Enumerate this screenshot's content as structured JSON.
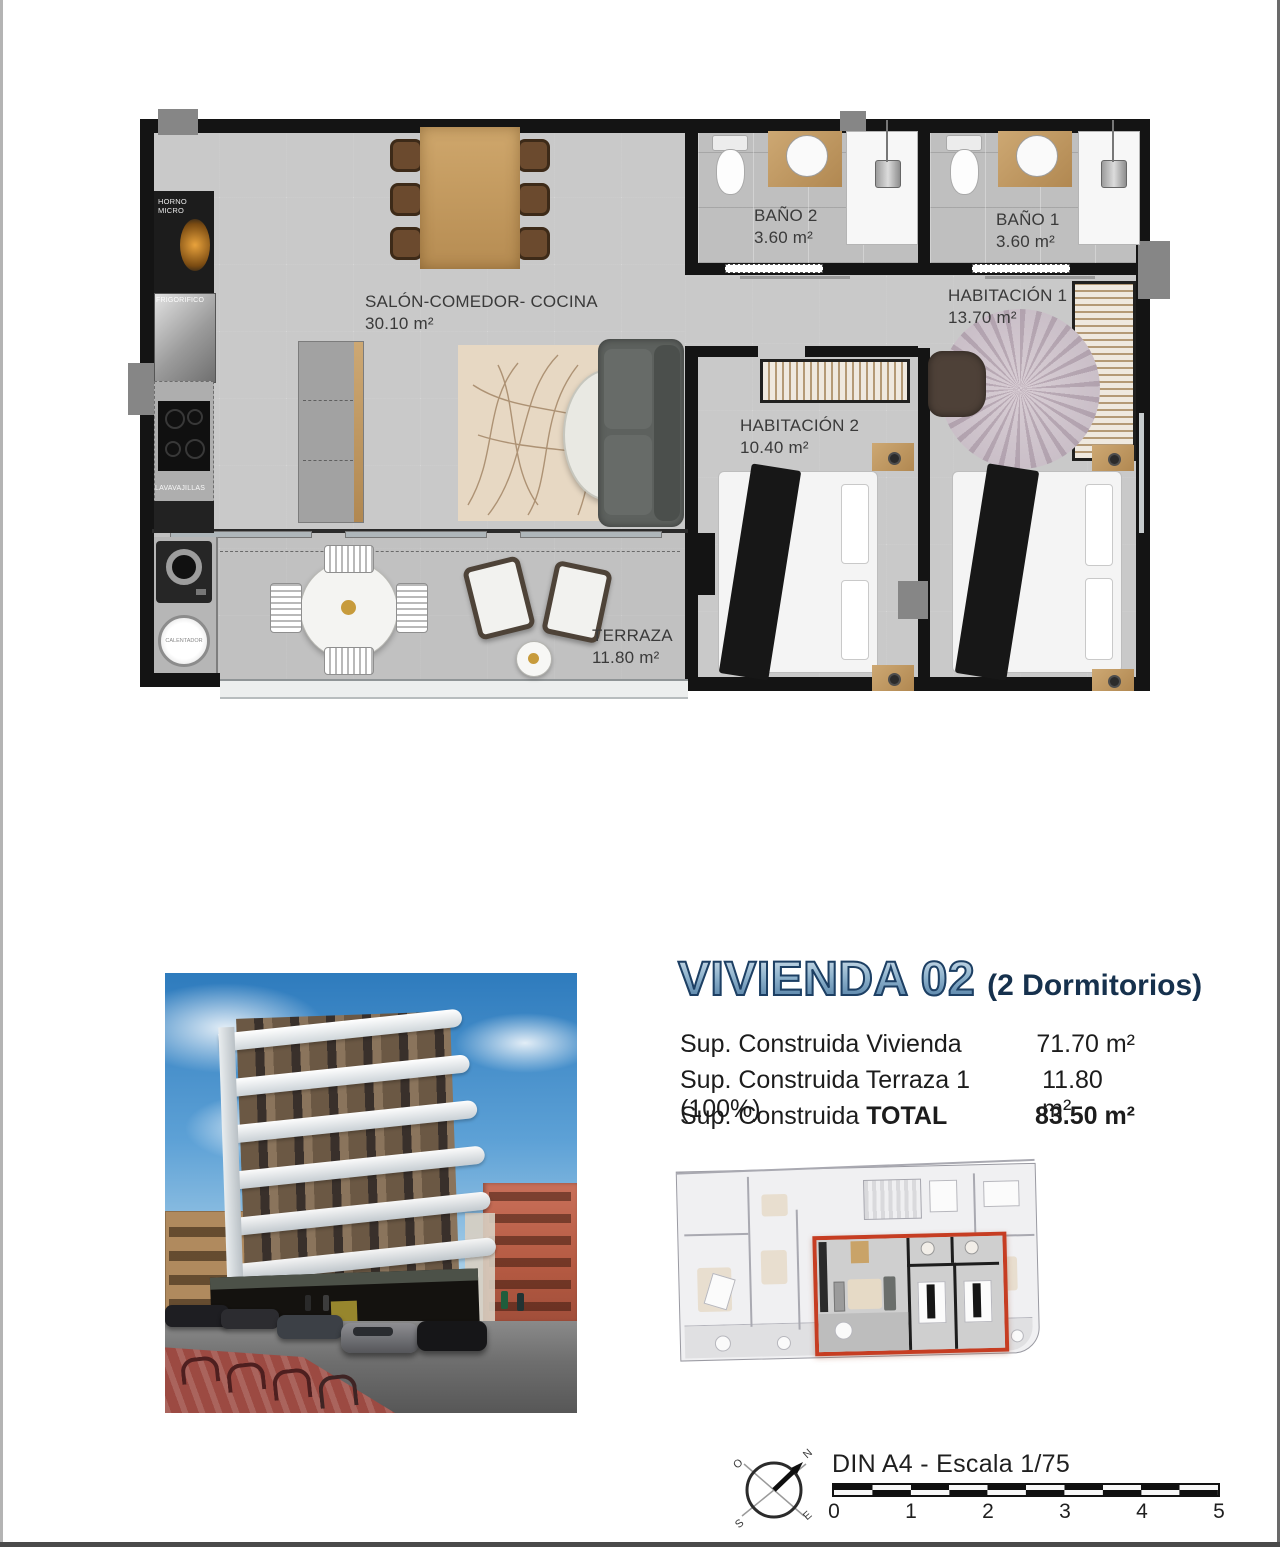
{
  "floorplan": {
    "rooms": {
      "salon": {
        "name": "SALÓN-COMEDOR- COCINA",
        "area": "30.10 m²"
      },
      "bano2": {
        "name": "BAÑO 2",
        "area": "3.60 m²"
      },
      "bano1": {
        "name": "BAÑO 1",
        "area": "3.60 m²"
      },
      "hab1": {
        "name": "HABITACIÓN 1",
        "area": "13.70 m²"
      },
      "hab2": {
        "name": "HABITACIÓN 2",
        "area": "10.40 m²"
      },
      "terraza": {
        "name": "TERRAZA",
        "area": "11.80 m²"
      }
    },
    "appliances": {
      "horno": "HORNO\nMICRO",
      "frigo": "FRIGORIFICO",
      "lavavajillas": "LAVAVAJILLAS",
      "calentador": "CALENTADOR"
    }
  },
  "unit": {
    "title": "VIVIENDA 02",
    "subtitle": "(2 Dormitorios)",
    "specs": [
      {
        "pre": "Sup. Construida Vivienda",
        "bold": "",
        "value": "71.70 m²"
      },
      {
        "pre": "Sup. Construida Terraza 1 (100%)",
        "bold": "",
        "value": "11.80 m²"
      },
      {
        "pre": "Sup. Construida ",
        "bold": "TOTAL",
        "value": "83.50 m²"
      }
    ]
  },
  "footer": {
    "scale_title": "DIN A4 - Escala 1/75",
    "scale_numbers": [
      "0",
      "1",
      "2",
      "3",
      "4",
      "5"
    ],
    "compass": {
      "n": "N",
      "s": "S",
      "e": "E",
      "o": "O"
    }
  },
  "colors": {
    "accent_red": "#c63d22",
    "title_blue": "#1d3f63",
    "wall_black": "#141414"
  }
}
